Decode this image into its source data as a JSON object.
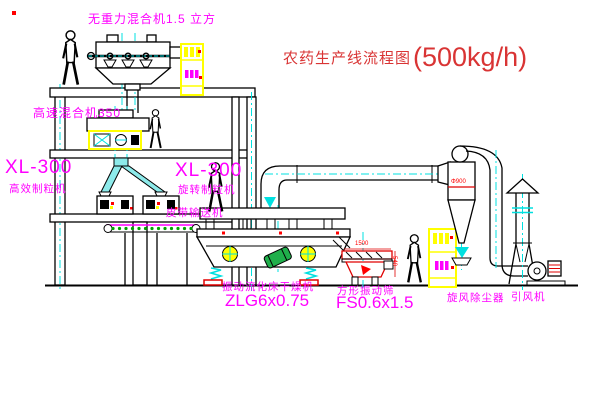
{
  "title": {
    "text": "农药生产线流程图",
    "capacity": "(500kg/h)"
  },
  "labels": {
    "gravity_free_mixer": "无重力混合机1.5 立方",
    "high_speed_mixer": "高速混合机350",
    "granulator_left_model": "XL-300",
    "granulator_left_name": "高效制粒机",
    "granulator_right_model": "XL-300",
    "granulator_right_name": "旋转制粒机",
    "belt_conveyor": "皮带输送机",
    "dryer_name": "振动流化床干燥机",
    "dryer_model": "ZLG6x0.75",
    "screen_name": "方形振动筛",
    "screen_model": "FS0.6x1.5",
    "cyclone": "旋风除尘器",
    "induced_draft_fan": "引风机"
  },
  "dimensions": {
    "screen_length": "1500",
    "screen_height": "540",
    "cyclone_note": "Φ900"
  },
  "colors": {
    "label_magenta": "#ff00ff",
    "title_red": "#d93434",
    "dimension_red": "#ff0000",
    "centerline_cyan": "#00e0e0",
    "cabinet_yellow": "#ffff00",
    "conveyor_green": "#00a000",
    "line_black": "#000000",
    "background": "#ffffff"
  }
}
